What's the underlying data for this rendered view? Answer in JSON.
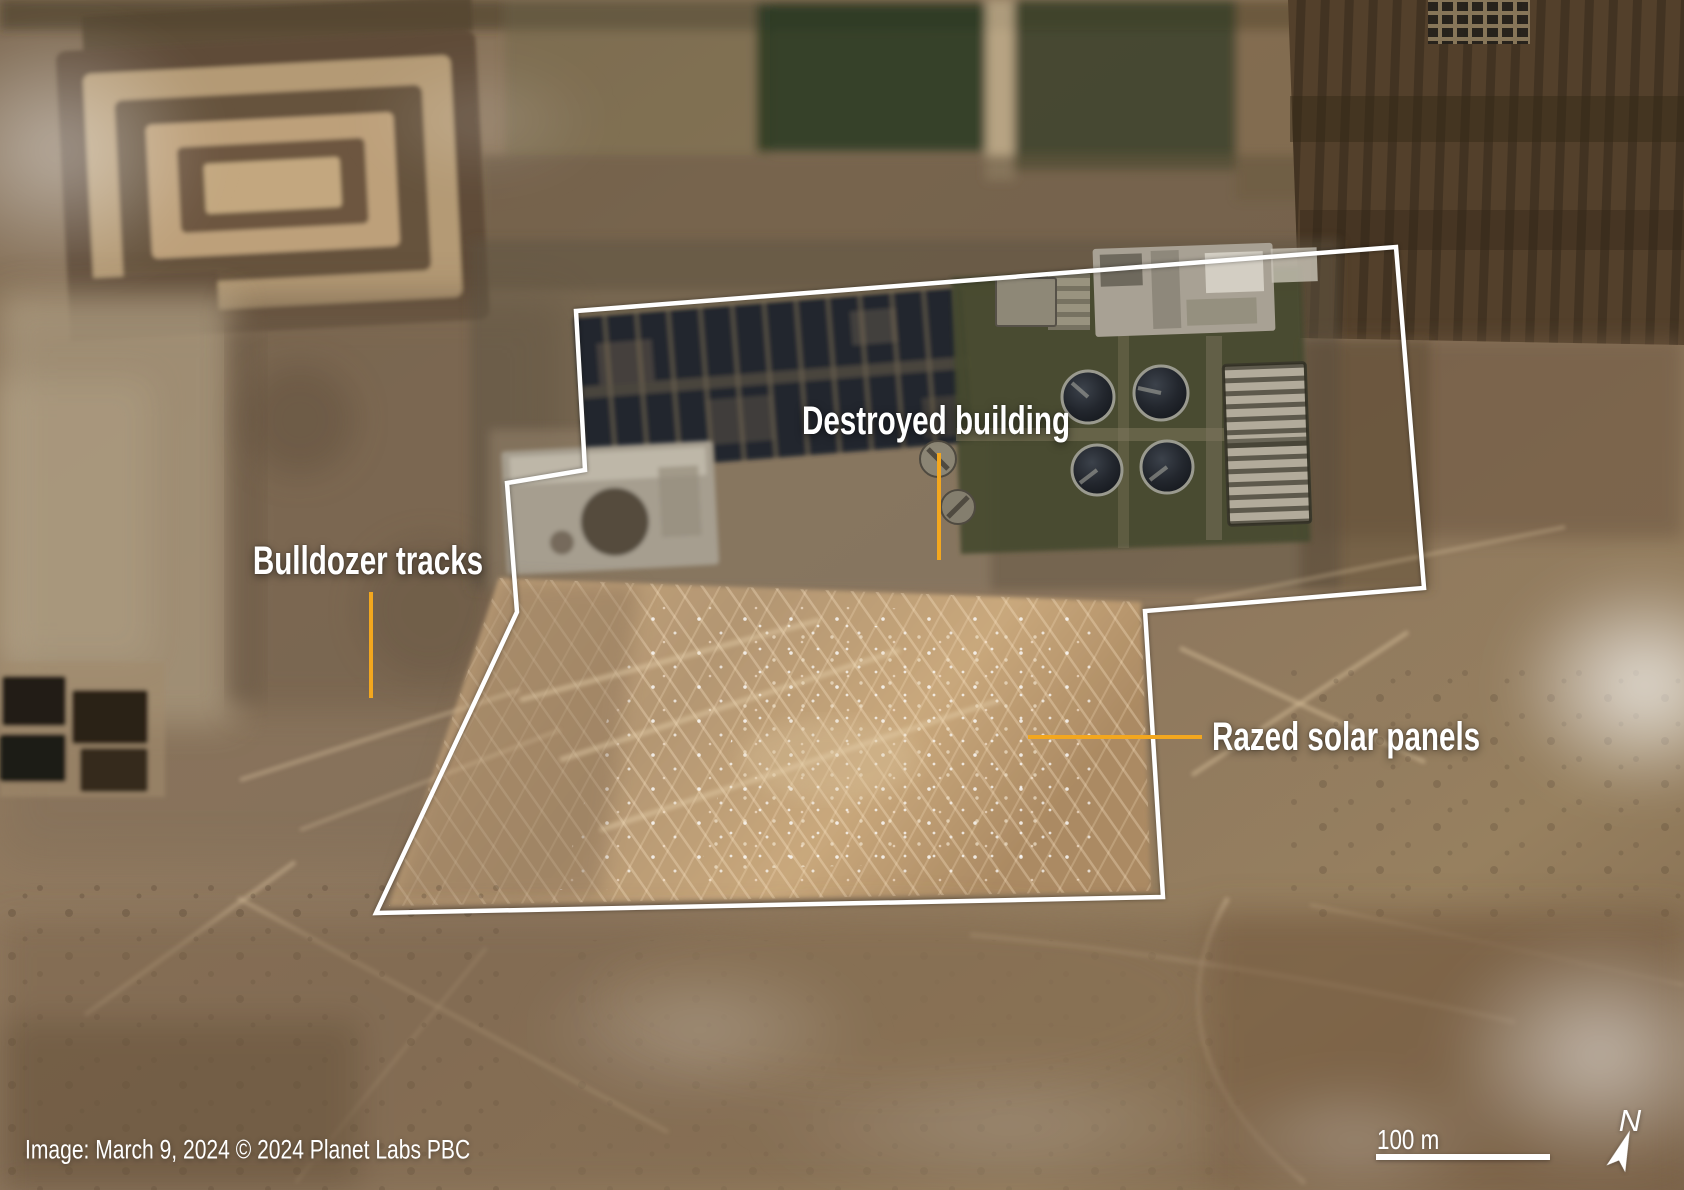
{
  "image": {
    "credit": "Image: March 9, 2024 © 2024 Planet Labs PBC",
    "type": "satellite-photo"
  },
  "annotations": [
    {
      "id": "destroyed-building",
      "label": "Destroyed building",
      "leader": "vertical"
    },
    {
      "id": "bulldozer-tracks",
      "label": "Bulldozer tracks",
      "leader": "vertical"
    },
    {
      "id": "razed-solar-panels",
      "label": "Razed solar panels",
      "leader": "horizontal"
    }
  ],
  "scale_bar": {
    "label": "100 m"
  },
  "compass": {
    "label": "N",
    "icon": "north-arrow"
  },
  "colors": {
    "annotation_accent": "#F3A71E",
    "outline": "#FFFFFF",
    "label_text": "#FFFFFF"
  }
}
